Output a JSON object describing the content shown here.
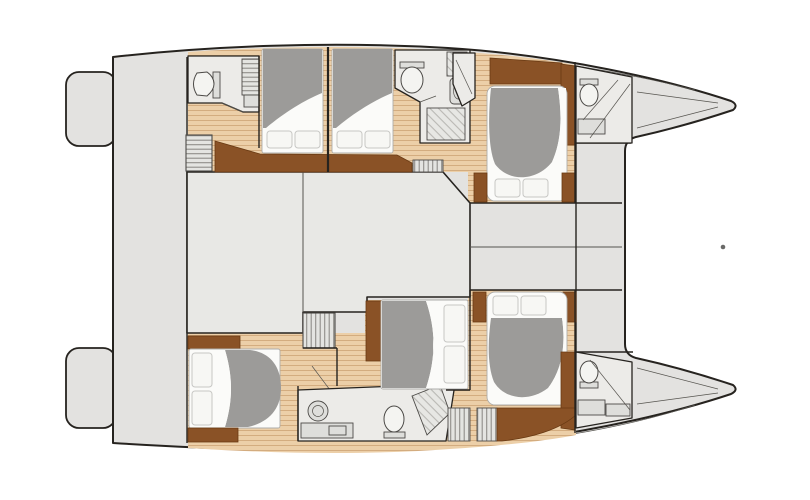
{
  "document": {
    "title": "Catamaran yacht deck plan - top-down interior layout, bow to the right",
    "type": "floor-plan",
    "background": "#ffffff"
  },
  "colors": {
    "outline": "#26231f",
    "deck": "#e3e2e0",
    "salon": "#e8e8e5",
    "room": "#ecebe8",
    "wood": "#eccfa8",
    "plank": "#d3ac7f",
    "woodDark": "#8a5226",
    "woodDarker": "#693a13",
    "duvet": "#9c9b99",
    "mattress": "#fbfbf9",
    "mattressEdge": "#aeadaa",
    "pillow": "#f7f7f4",
    "pillowEdge": "#c7c7c4",
    "fixture": "#dededb",
    "fixtureEdge": "#4c4a47",
    "toilet": "#f4f4f1",
    "lineThin": "#56544f",
    "stripe": "#8f8d89",
    "dot": "#6a6a68"
  },
  "legend": {
    "vessel": "sailing catamaran, two hulls joined by bridgedeck, bow pointing right",
    "amidships": [
      "aft swim platforms",
      "aft cockpit",
      "salon",
      "forward cockpit",
      "foredeck between bows"
    ],
    "hulls": [
      {
        "name": "upper hull",
        "rooms": [
          "aft head with toilet",
          "companionway stairs",
          "guest cabin 1 with double bed",
          "guest cabin 2 with double bed",
          "mid head with toilet, sink and shower",
          "forward owner cabin with island bed",
          "bow head with toilet",
          "bow locker"
        ]
      },
      {
        "name": "lower hull",
        "rooms": [
          "aft cabin with double bed",
          "companionway stairs",
          "mid head with sink, toilet and shower",
          "mid cabin with double bed",
          "forward owner cabin with island bed",
          "bow head with toilet",
          "bow locker"
        ]
      }
    ],
    "counts": {
      "cabins": 6,
      "beds": 6,
      "heads": 5,
      "stairways": 2,
      "swim_platforms": 2
    }
  },
  "annotations": {
    "forestay_dot": {
      "x": 723,
      "y": 247,
      "radius": 2.3
    }
  }
}
